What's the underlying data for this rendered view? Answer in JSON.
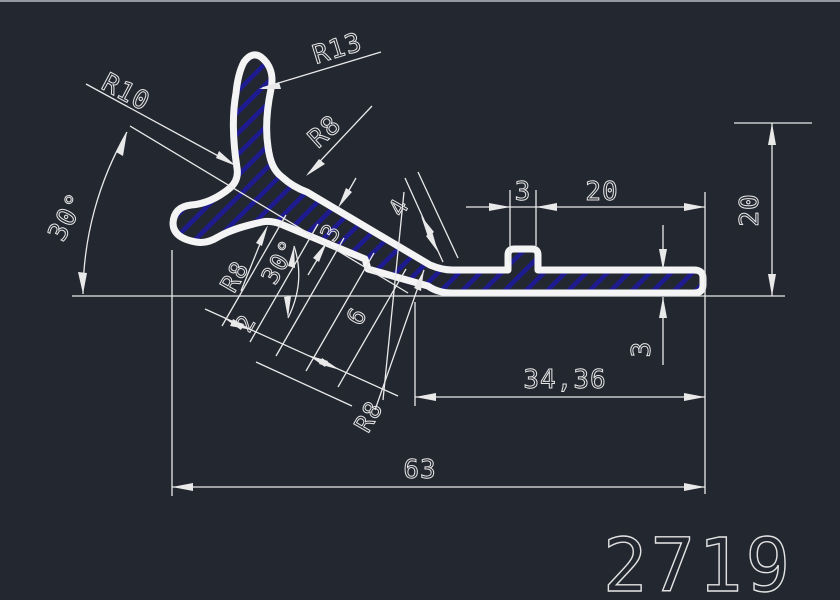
{
  "app": {
    "type_label": "CAD profile drawing",
    "part_number": "2719",
    "colors": {
      "background": "#232730",
      "line": "#e9e9e9",
      "profile_outline": "#f4f4f4",
      "hatch": "#1e1b90"
    }
  },
  "dims": {
    "r10": "R10",
    "r13": "R13",
    "r8_top": "R8",
    "angle_left": "30°",
    "r8_mid": "R8",
    "angle_mid": "30°",
    "thickness_incline": "3",
    "offset_4": "4",
    "offset_6": "6",
    "offset_2": "2",
    "r8_bottom": "R8",
    "notch_width": "3",
    "top_length": "20",
    "height_right": "20",
    "thickness_right": "3",
    "length_mid": "34,36",
    "length_total": "63"
  }
}
